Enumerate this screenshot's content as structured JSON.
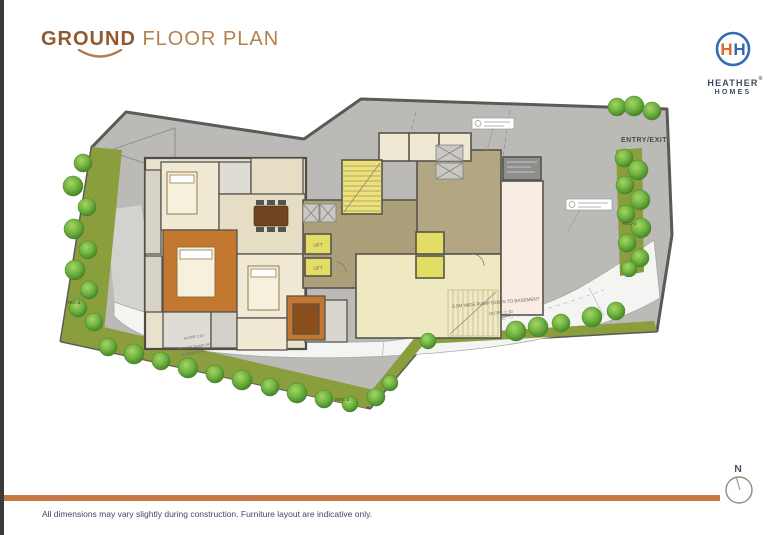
{
  "header": {
    "title_bold": "GROUND",
    "title_rest": " FLOOR PLAN",
    "accent_color": "#a4683a"
  },
  "logo": {
    "name_line1": "HEATHER",
    "name_line2": "HOMES",
    "reg_mark": "®",
    "monogram_left": "H",
    "monogram_right": "H",
    "ring_color": "#2f6cb3",
    "monogram_orange": "#e2662c",
    "monogram_blue": "#2f6cb3",
    "text_color": "#3c4d5e"
  },
  "plan": {
    "site_color": "#bcbab7",
    "landscape_color": "#8b9e3d",
    "ramp_color": "#f4f4f2",
    "wall_color": "#57544e",
    "wood_floor_color": "#c4772e",
    "lift_yellow": "#e3dd66",
    "labels": {
      "entry_exit": "ENTRY/EXIT",
      "rec_1": "REC-1",
      "rec_2": "REC-2",
      "rec_3": "REC-3",
      "ramp_down_line1": "6.0M WIDE RAMP DOWN TO BASEMENT",
      "ramp_down_line2": "SLOPE 1:10",
      "ramp_up_line1": "SLOPE 1:10",
      "ramp_up_line2": "6M WIDE RAMP UP",
      "ramp_up_line3": "TO BASEMENT",
      "lift": "LIFT",
      "north": "N"
    }
  },
  "footer": {
    "divider_color": "#c57a44",
    "disclaimer": "All dimensions may vary slightly during construction. Furniture layout are indicative only."
  }
}
